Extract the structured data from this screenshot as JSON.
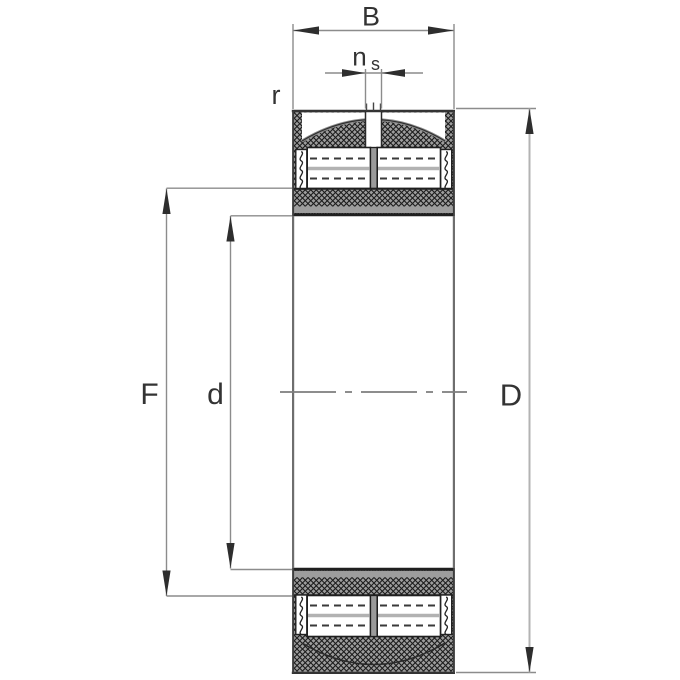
{
  "drawing": {
    "labels": {
      "width": "B",
      "lube_offset": "n",
      "lube_offset_sub": "s",
      "chamfer": "r",
      "raceway_diameter": "F",
      "bore_diameter": "d",
      "outside_diameter": "D"
    },
    "colors": {
      "background": "#ffffff",
      "outline": "#3d3d3d",
      "dimension_line": "#8c8c8c",
      "dimension_line_light": "#b3b3b3",
      "arrowhead": "#2e2e2e",
      "label_text": "#333333",
      "hatch_base": "#9d9d9d",
      "hatch_line": "#1c1c1c",
      "roller_axis": "#b2b2b2",
      "center_axis": "#7d7d7d"
    }
  }
}
